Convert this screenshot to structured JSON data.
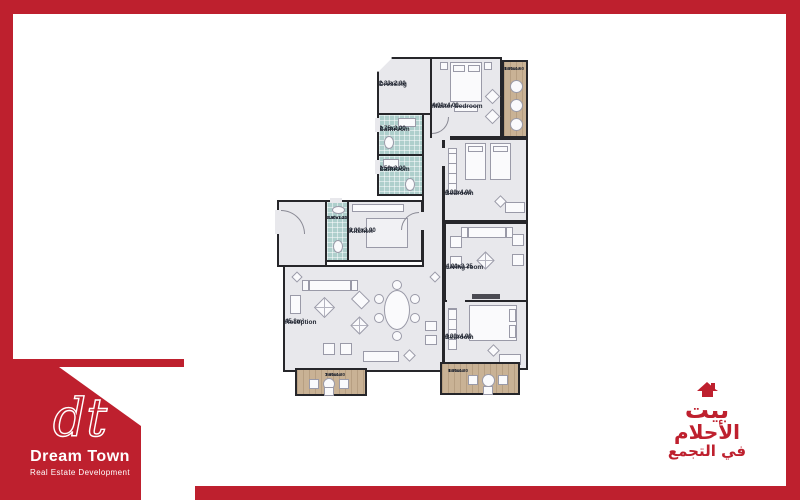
{
  "brand": {
    "monogram": "dt",
    "name": "Dream Town",
    "tagline": "Real Estate Development"
  },
  "arabic_logo": {
    "line1": "بيت",
    "line2": "الأحلام",
    "line3": "في التجمع"
  },
  "colors": {
    "brand_red": "#be202e",
    "wall": "#26262a",
    "floor_gray": "#e8e8ec",
    "bathroom_tile": "#aecfcc",
    "terrace_wood": "#c9b295"
  },
  "plan": {
    "rooms": {
      "dressing": {
        "name": "Dressing",
        "dims": "2.33x2.00"
      },
      "bath1": {
        "name": "Bathroom",
        "dims": "2.75x2.00"
      },
      "bath2": {
        "name": "Bathroom",
        "dims": "2.50x2.00"
      },
      "bath3": {
        "name": "Bathroom",
        "dims": "3.90x1.22"
      },
      "master": {
        "name": "Master bedroom",
        "dims": "4.00x4.00"
      },
      "terrace_top": {
        "name": "Terrace",
        "dims": "4.00x1.50"
      },
      "bedroom_mid": {
        "name": "Bedroom",
        "dims": "4.00x4.00"
      },
      "kitchen": {
        "name": "Kitchen",
        "dims": "3.00x3.90"
      },
      "living": {
        "name": "Living room",
        "dims": "4.00x3.25"
      },
      "reception": {
        "name": "Reception",
        "dims": "45.8m²"
      },
      "bedroom_bottom": {
        "name": "Bedroom",
        "dims": "4.00x4.00"
      },
      "terrace_bl": {
        "name": "Terrace",
        "dims": "3.60x1.30"
      },
      "terrace_br": {
        "name": "Terrace",
        "dims": "4.00x1.30"
      }
    }
  }
}
